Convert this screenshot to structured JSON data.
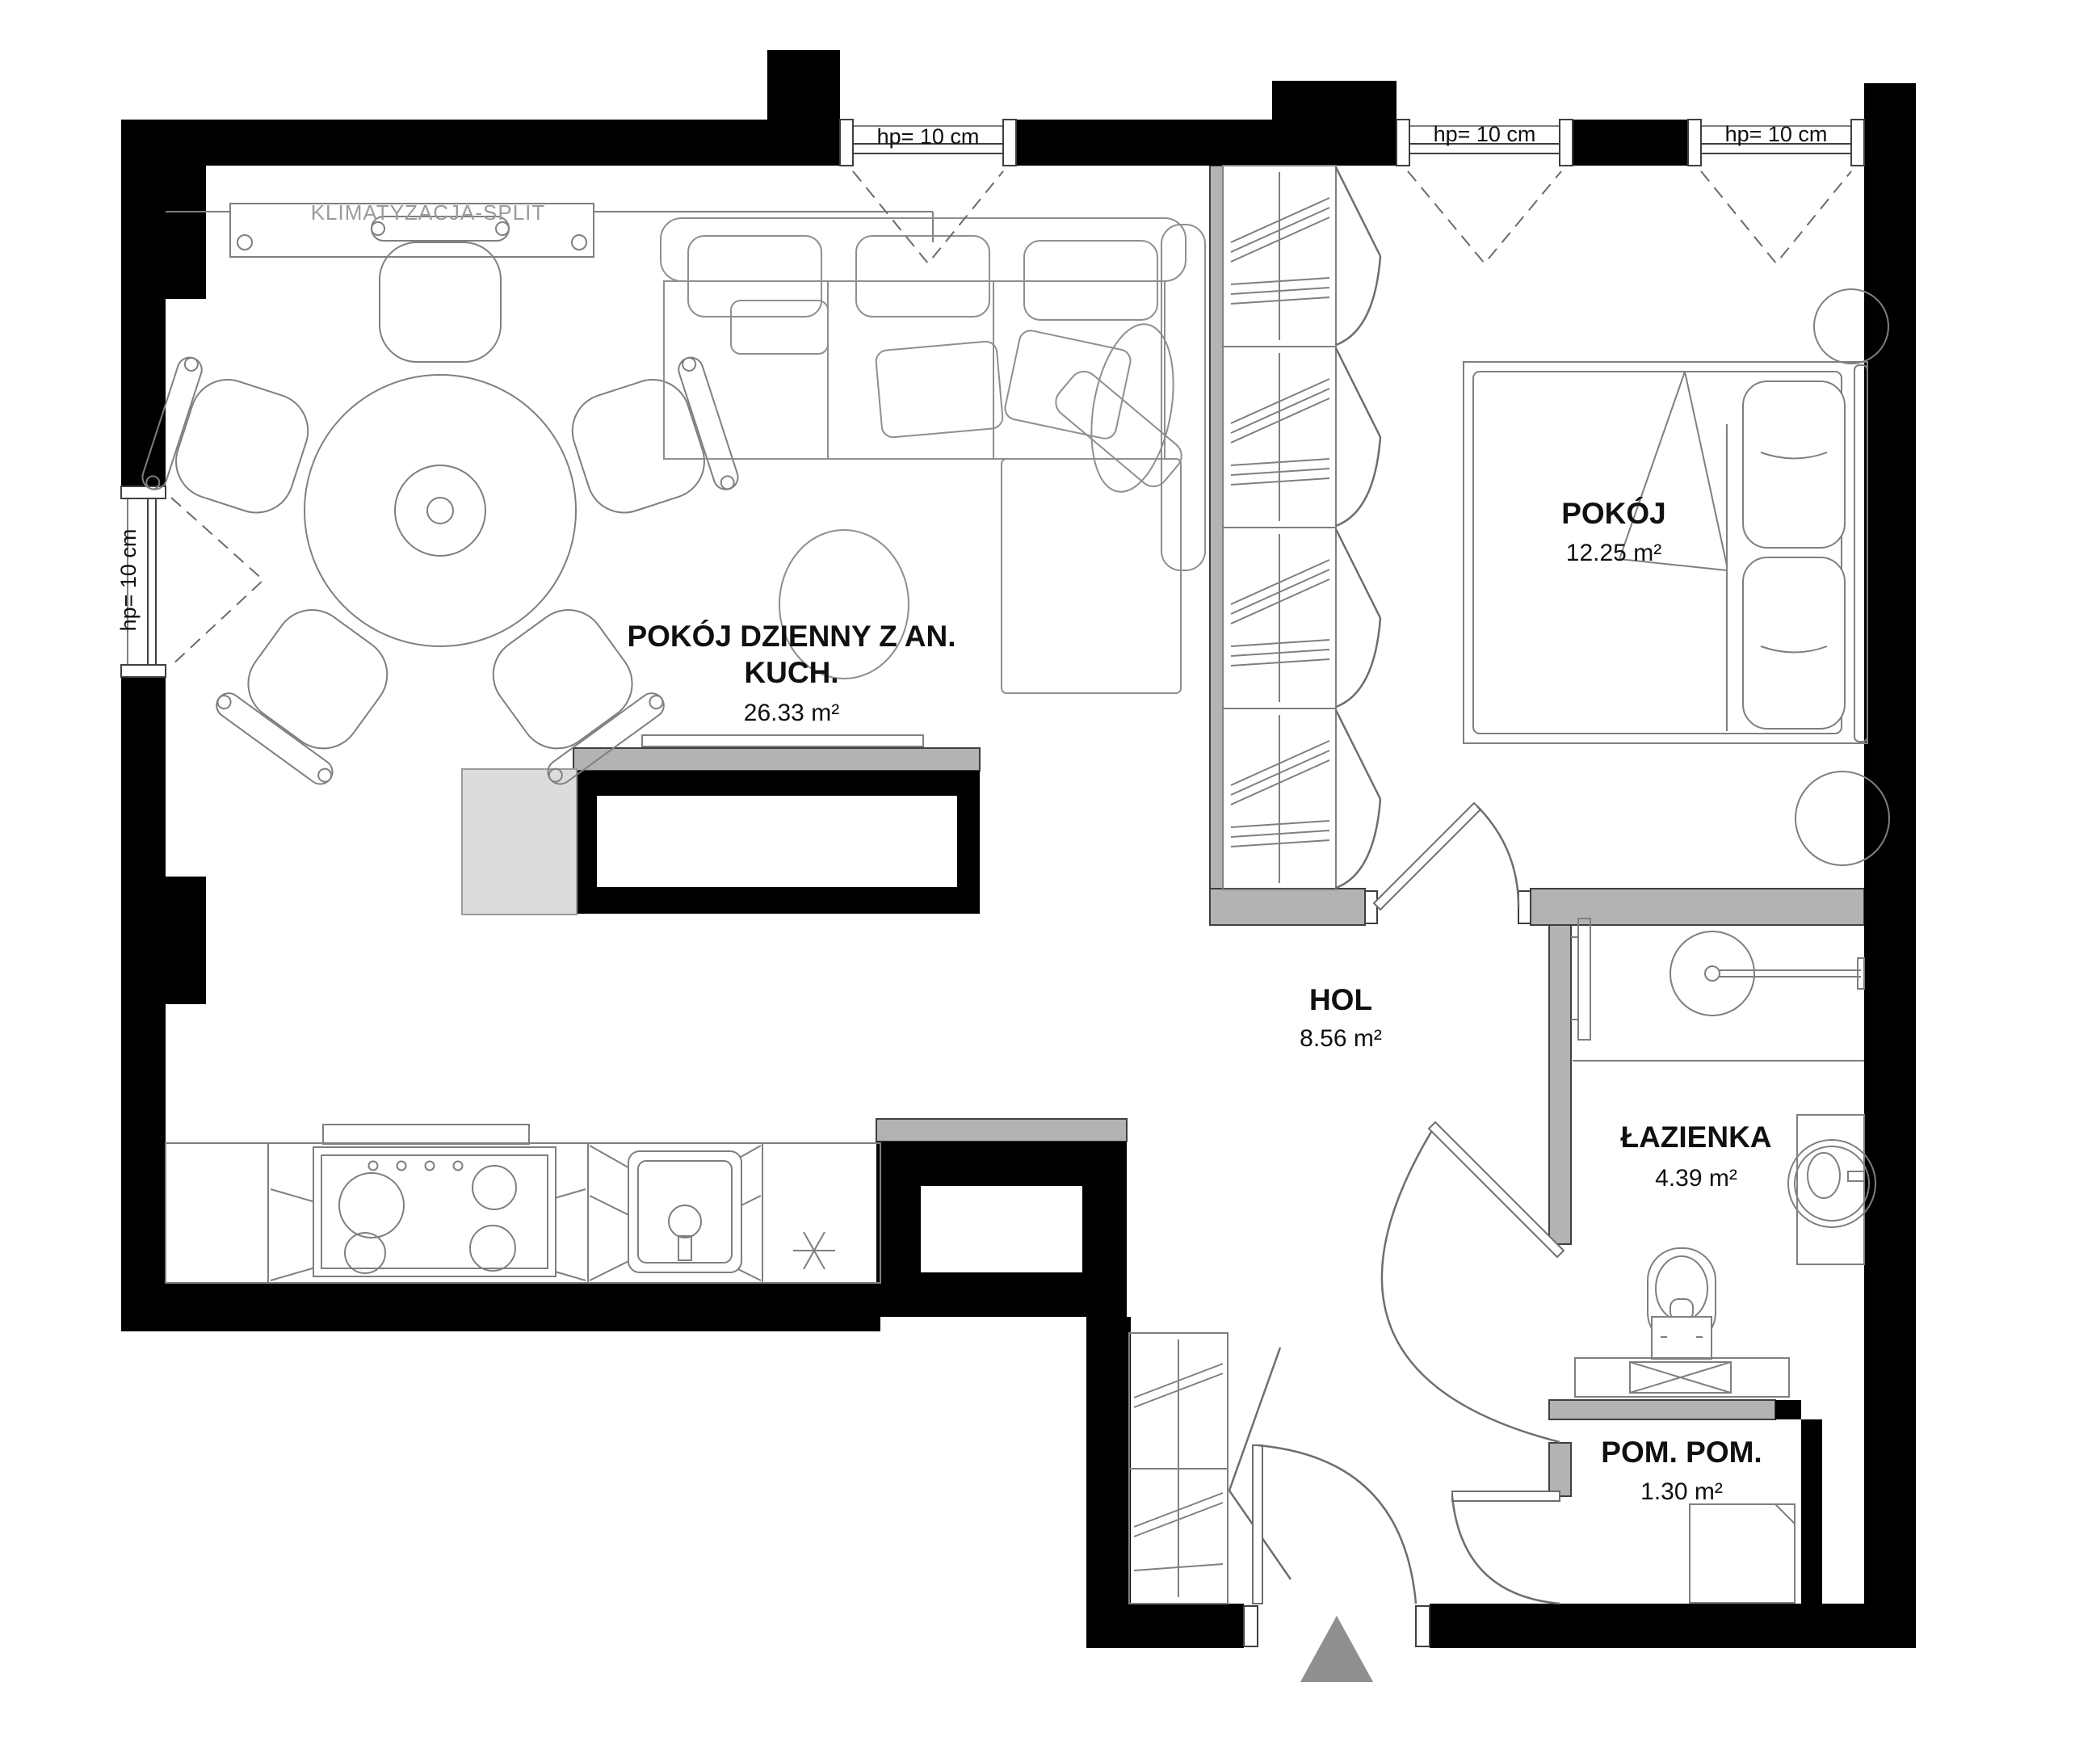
{
  "plan": {
    "ac_label": "KLIMATYZACJA-SPLIT",
    "windows": {
      "top1": "hp= 10 cm",
      "top2": "hp= 10 cm",
      "top3": "hp= 10 cm",
      "left": "hp= 10 cm"
    },
    "rooms": {
      "living": {
        "name_line1": "POKÓJ DZIENNY Z AN.",
        "name_line2": "KUCH.",
        "area": "26.33 m²"
      },
      "bedroom": {
        "name": "POKÓJ",
        "area": "12.25 m²"
      },
      "hall": {
        "name": "HOL",
        "area": "8.56 m²"
      },
      "bathroom": {
        "name": "ŁAZIENKA",
        "area": "4.39 m²"
      },
      "utility": {
        "name": "POM. POM.",
        "area": "1.30 m²"
      }
    },
    "colors": {
      "wall": "#000000",
      "partition": "#b3b3b3",
      "furniture_line": "#7f7f7f",
      "light_fill": "#dcdcdc",
      "entry_arrow": "#8f8f8f",
      "ac_text": "#9b9b9b",
      "text": "#101010"
    }
  }
}
